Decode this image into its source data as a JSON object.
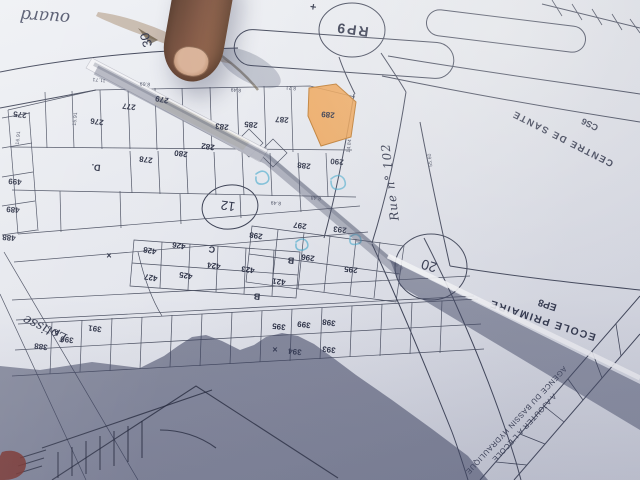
{
  "scene": {
    "description": "Photograph of a paper cadastral subdivision plan, pointed at by a finger, photographer's shadow at bottom"
  },
  "labels": {
    "handwriting": "ouard",
    "plus_mark": "+",
    "roundabout": "RP9",
    "width_30": "30",
    "width_12": "12",
    "width_20": "20",
    "rue_102": "Rue n° 102",
    "lotissement": "Lotisse",
    "centre_sante": "CENTRE DE SANTE",
    "centre_sante_code": "CS6",
    "ecole": "ECOLE PRIMAIRE",
    "ecole_code": "EP8",
    "annotation_1": "A AJOUTER A L'ECOLE",
    "annotation_2": "AGENCE DU BASSIN HYDRAULIQUE",
    "highlighted_parcel": "289",
    "highlight_color": "#f0a14e"
  },
  "positioned_labels": [
    {
      "t": "275",
      "x": 20,
      "y": 114,
      "r": 186,
      "k": "plot"
    },
    {
      "t": "276",
      "x": 97,
      "y": 121,
      "r": 188,
      "k": "plot"
    },
    {
      "t": "277",
      "x": 129,
      "y": 106,
      "r": 186,
      "k": "plot"
    },
    {
      "t": "279",
      "x": 162,
      "y": 99,
      "r": 192,
      "k": "plot"
    },
    {
      "t": "278",
      "x": 146,
      "y": 159,
      "r": 187,
      "k": "plot"
    },
    {
      "t": "280",
      "x": 181,
      "y": 153,
      "r": 187,
      "k": "plot"
    },
    {
      "t": "282",
      "x": 208,
      "y": 146,
      "r": 188,
      "k": "plot"
    },
    {
      "t": "283",
      "x": 222,
      "y": 126,
      "r": 186,
      "k": "plot"
    },
    {
      "t": "285",
      "x": 251,
      "y": 124,
      "r": 185,
      "k": "plot"
    },
    {
      "t": "287",
      "x": 282,
      "y": 119,
      "r": 184,
      "k": "plot"
    },
    {
      "t": "289",
      "x": 328,
      "y": 114,
      "r": 185,
      "k": "plot"
    },
    {
      "t": "288",
      "x": 304,
      "y": 165,
      "r": 186,
      "k": "plot"
    },
    {
      "t": "290",
      "x": 337,
      "y": 161,
      "r": 185,
      "k": "plot"
    },
    {
      "t": "499",
      "x": 15,
      "y": 181,
      "r": 185,
      "k": "plot"
    },
    {
      "t": "489",
      "x": 13,
      "y": 209,
      "r": 185,
      "k": "plot"
    },
    {
      "t": "488",
      "x": 9,
      "y": 237,
      "r": 185,
      "k": "plot"
    },
    {
      "t": "298",
      "x": 256,
      "y": 235,
      "r": 188,
      "k": "plot"
    },
    {
      "t": "297",
      "x": 300,
      "y": 225,
      "r": 188,
      "k": "plot"
    },
    {
      "t": "296",
      "x": 308,
      "y": 257,
      "r": 188,
      "k": "plot"
    },
    {
      "t": "295",
      "x": 351,
      "y": 269,
      "r": 186,
      "k": "plot"
    },
    {
      "t": "293",
      "x": 340,
      "y": 229,
      "r": 186,
      "k": "plot"
    },
    {
      "t": "428",
      "x": 150,
      "y": 250,
      "r": 190,
      "k": "plot"
    },
    {
      "t": "426",
      "x": 179,
      "y": 245,
      "r": 190,
      "k": "plot"
    },
    {
      "t": "427",
      "x": 151,
      "y": 277,
      "r": 190,
      "k": "plot"
    },
    {
      "t": "425",
      "x": 186,
      "y": 275,
      "r": 190,
      "k": "plot"
    },
    {
      "t": "424",
      "x": 214,
      "y": 265,
      "r": 188,
      "k": "plot"
    },
    {
      "t": "423",
      "x": 248,
      "y": 269,
      "r": 188,
      "k": "plot"
    },
    {
      "t": "421",
      "x": 279,
      "y": 281,
      "r": 186,
      "k": "plot"
    },
    {
      "t": "391",
      "x": 95,
      "y": 328,
      "r": 187,
      "k": "plot"
    },
    {
      "t": "390",
      "x": 67,
      "y": 339,
      "r": 187,
      "k": "plot"
    },
    {
      "t": "388",
      "x": 41,
      "y": 346,
      "r": 187,
      "k": "plot"
    },
    {
      "t": "398",
      "x": 329,
      "y": 322,
      "r": 187,
      "k": "plot"
    },
    {
      "t": "399",
      "x": 304,
      "y": 324,
      "r": 187,
      "k": "plot"
    },
    {
      "t": "395",
      "x": 279,
      "y": 326,
      "r": 186,
      "k": "plot"
    },
    {
      "t": "394",
      "x": 295,
      "y": 351,
      "r": 186,
      "k": "plot"
    },
    {
      "t": "393",
      "x": 329,
      "y": 349,
      "r": 186,
      "k": "plot"
    },
    {
      "t": "D.",
      "x": 96,
      "y": 167,
      "r": 186,
      "k": "mark"
    },
    {
      "t": "C",
      "x": 212,
      "y": 249,
      "r": 187,
      "k": "mark"
    },
    {
      "t": "B",
      "x": 291,
      "y": 260,
      "r": 186,
      "k": "mark"
    },
    {
      "t": "B",
      "x": 257,
      "y": 296,
      "r": 186,
      "k": "mark"
    },
    {
      "t": "A",
      "x": 57,
      "y": 332,
      "r": 187,
      "k": "mark"
    },
    {
      "t": "×",
      "x": 109,
      "y": 256,
      "r": 0,
      "k": "mark"
    },
    {
      "t": "×",
      "x": 275,
      "y": 350,
      "r": 0,
      "k": "mark"
    },
    {
      "t": "11.71",
      "x": 99,
      "y": 79,
      "r": 186,
      "k": "dim"
    },
    {
      "t": "8.69",
      "x": 145,
      "y": 83,
      "r": 186,
      "k": "dim"
    },
    {
      "t": "8.49",
      "x": 236,
      "y": 89,
      "r": 186,
      "k": "dim"
    },
    {
      "t": "8.21",
      "x": 291,
      "y": 87,
      "r": 186,
      "k": "dim"
    },
    {
      "t": "16.91",
      "x": 19,
      "y": 138,
      "r": 276,
      "k": "dim"
    },
    {
      "t": "15.91",
      "x": 76,
      "y": 119,
      "r": 276,
      "k": "dim"
    },
    {
      "t": "14.84",
      "x": 350,
      "y": 146,
      "r": 276,
      "k": "dim"
    },
    {
      "t": "8.48",
      "x": 316,
      "y": 197,
      "r": 186,
      "k": "dim"
    },
    {
      "t": "8.49",
      "x": 276,
      "y": 202,
      "r": 186,
      "k": "dim"
    },
    {
      "t": "55.60",
      "x": 431,
      "y": 160,
      "r": 264,
      "k": "dim"
    }
  ]
}
